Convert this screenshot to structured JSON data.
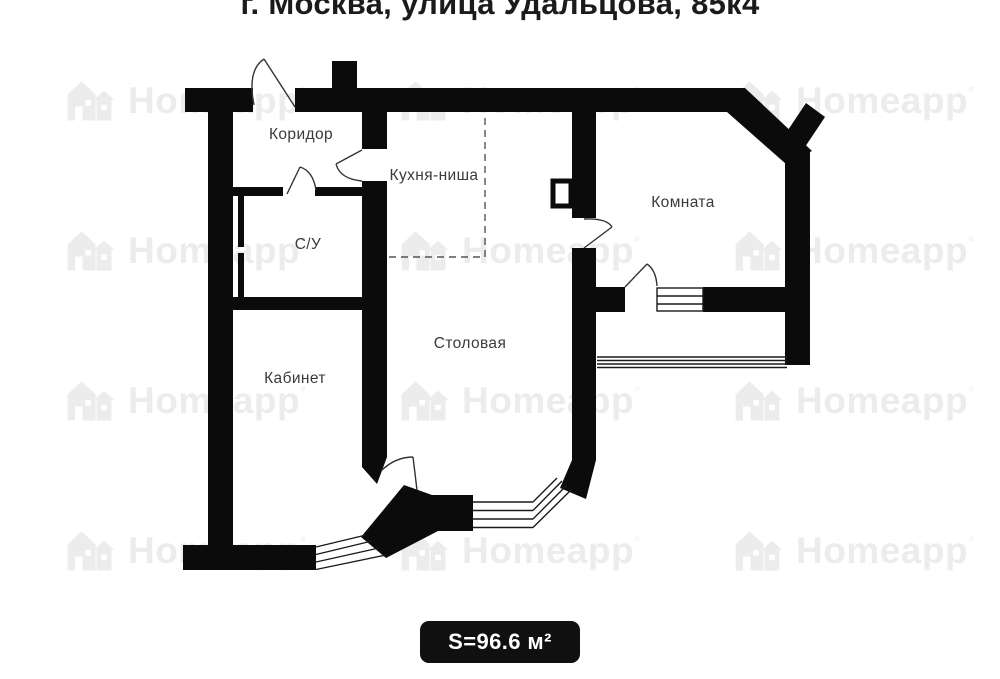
{
  "title": "г. Москва, улица Удальцова, 85к4",
  "area_badge": "S=96.6 м²",
  "watermark": {
    "text": "Homeapp",
    "mark": "°"
  },
  "rooms": {
    "corridor": "Коридор",
    "kitchen_niche": "Кухня-ниша",
    "bathroom": "С/У",
    "room": "Комната",
    "office": "Кабинет",
    "dining": "Столовая"
  },
  "colors": {
    "wall": "#0b0b0b",
    "label": "#3a3a3a",
    "badge_bg": "#101010",
    "watermark": "#ececec"
  }
}
